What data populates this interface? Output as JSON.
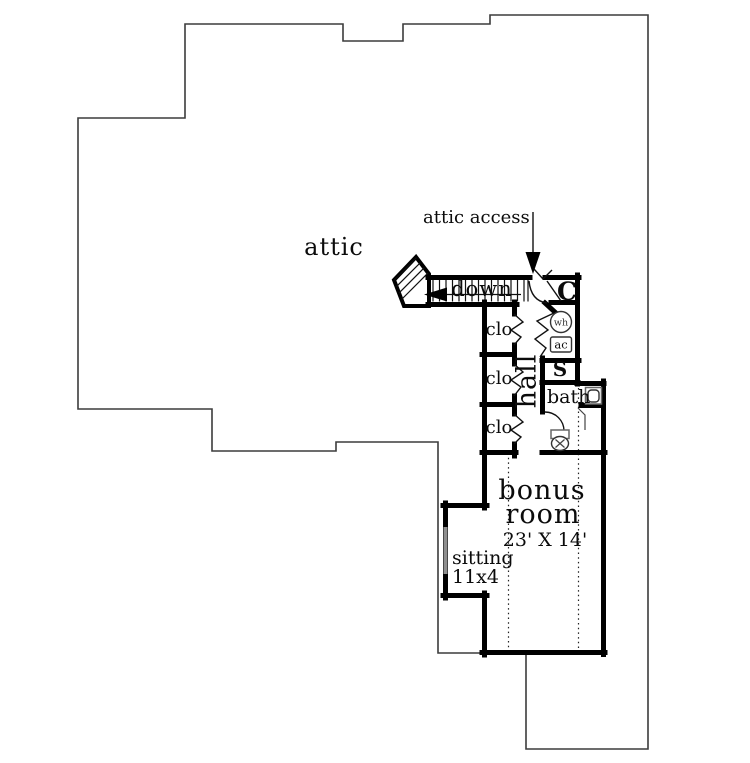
{
  "plan": {
    "type": "second-floor attic plan",
    "colors": {
      "wall": "#000000",
      "outline": "#3c3c3c",
      "text": "#0b0b0b",
      "window": "#8f8f8f"
    }
  },
  "rooms": {
    "attic": {
      "label": "attic"
    },
    "attic_access": {
      "label": "attic access"
    },
    "stairs": {
      "label": "down"
    },
    "closets": [
      {
        "label": "clo"
      },
      {
        "label": "clo"
      },
      {
        "label": "clo"
      }
    ],
    "hall": {
      "label": "hall"
    },
    "closet_c": {
      "label": "C"
    },
    "utilities": {
      "water_heater": "wh",
      "ac_unit": "ac"
    },
    "storage": {
      "label": "S"
    },
    "bath": {
      "label": "bath"
    },
    "bonus_room": {
      "label_line1": "bonus",
      "label_line2": "room",
      "dimensions": "23' X 14'"
    },
    "sitting": {
      "label": "sitting",
      "dimensions": "11x4"
    }
  }
}
